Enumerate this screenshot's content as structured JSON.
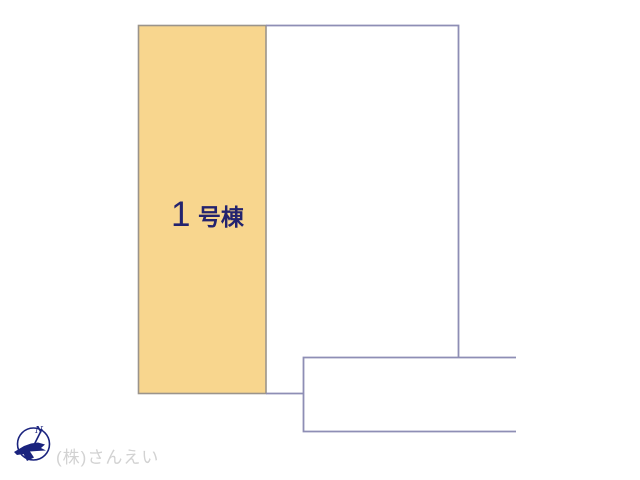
{
  "site_plan": {
    "parcel_1": {
      "number": "1",
      "suffix": "号棟",
      "full_label": "1号棟",
      "fill": "#F8D68E",
      "border_color": "#9B948B",
      "label_color": "#23236E"
    },
    "boundary": {
      "line_color": "#8E8EB5"
    }
  },
  "compass": {
    "north_label": "N",
    "color": "#1A237E"
  },
  "footer": {
    "company": "(株)さんえい",
    "color": "#D2D2D2"
  }
}
